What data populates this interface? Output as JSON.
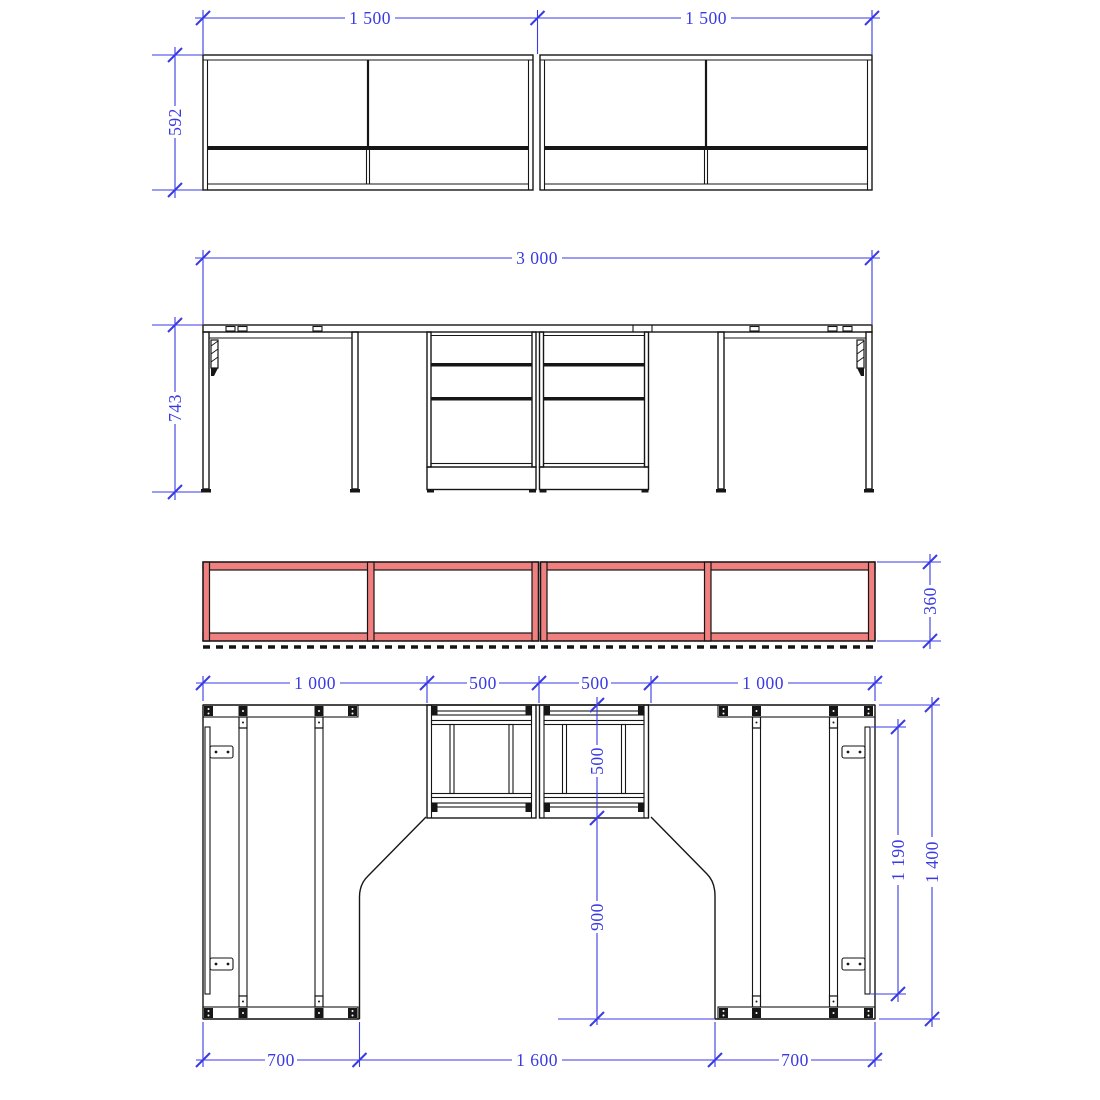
{
  "drawing": {
    "type": "furniture-workstation-technical-drawing",
    "colors": {
      "dimension_blue": "#3A3AE4",
      "line_black": "#161616",
      "highlight_red_fill": "#F08080",
      "background": "#FFFFFF"
    },
    "views": [
      {
        "name": "cabinet-elevation"
      },
      {
        "name": "desk-elevation"
      },
      {
        "name": "shelf-elevation-highlighted"
      },
      {
        "name": "plan-view"
      }
    ]
  },
  "dims": {
    "cabinet_width_left": "1 500",
    "cabinet_width_right": "1 500",
    "cabinet_height": "592",
    "desk_total_width": "3 000",
    "desk_height": "743",
    "shelf_height": "360",
    "plan_top_left": "1 000",
    "plan_top_mid_left": "500",
    "plan_top_mid_right": "500",
    "plan_top_right": "1 000",
    "plan_pedestal_depth": "500",
    "plan_leg_clearance": "900",
    "plan_side_rail_length": "1 190",
    "plan_total_depth": "1 400",
    "plan_bottom_left": "700",
    "plan_bottom_middle": "1 600",
    "plan_bottom_right": "700"
  }
}
